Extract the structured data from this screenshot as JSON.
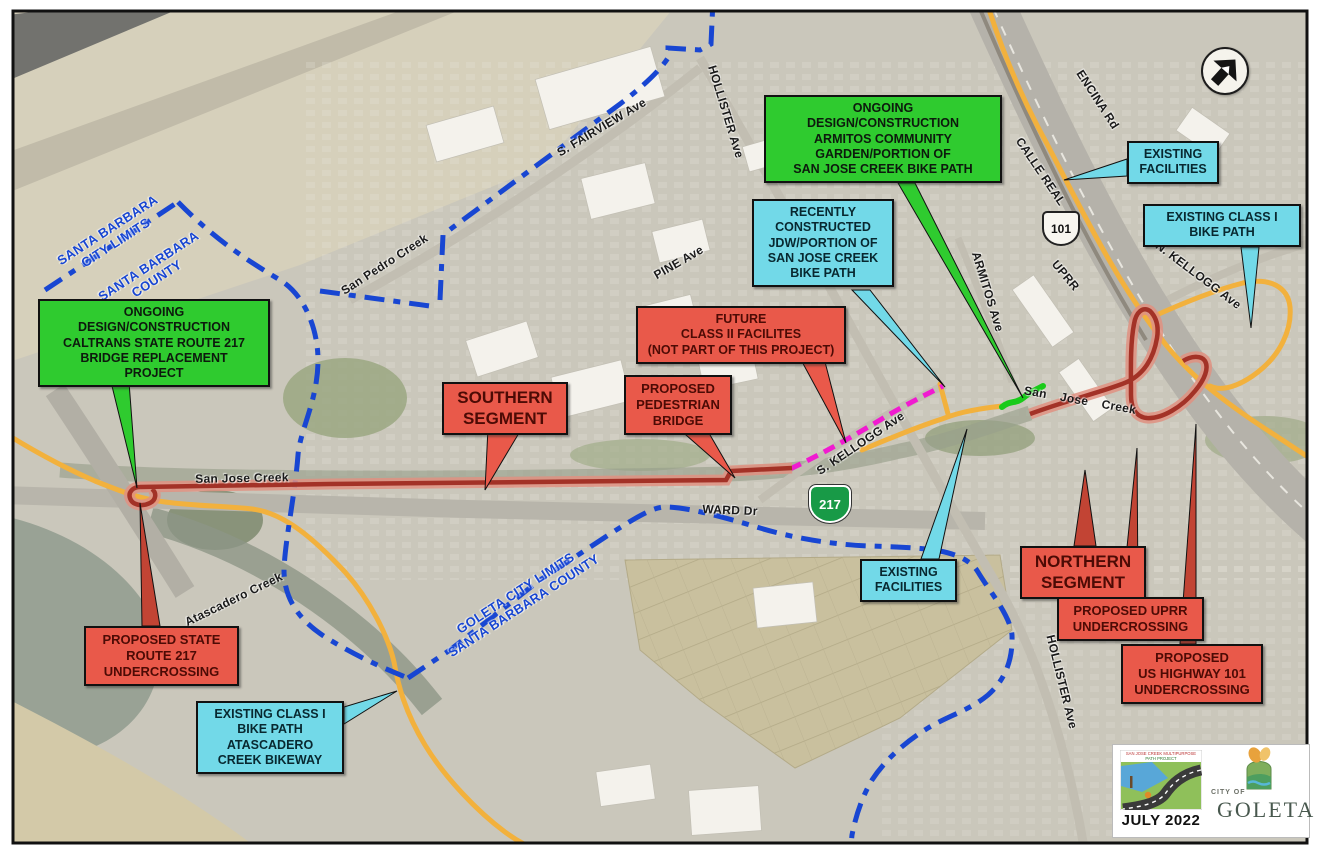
{
  "callouts": {
    "caltrans": "ONGOING\nDESIGN/CONSTRUCTION\nCALTRANS STATE ROUTE 217\nBRIDGE REPLACEMENT\nPROJECT",
    "garden": "ONGOING\nDESIGN/CONSTRUCTION\nARMITOS COMMUNITY\nGARDEN/PORTION OF\nSAN JOSE CREEK BIKE PATH",
    "recently": "RECENTLY\nCONSTRUCTED\nJDW/PORTION OF\nSAN JOSE CREEK\nBIKE PATH",
    "existing_facilities_ne": "EXISTING\nFACILITIES",
    "existing_class1_ne": "EXISTING CLASS I\nBIKE PATH",
    "future": "FUTURE\nCLASS II FACILITES\n(NOT PART OF THIS PROJECT)",
    "southern": "SOUTHERN\nSEGMENT",
    "pedestrian": "PROPOSED\nPEDESTRIAN\nBRIDGE",
    "r217": "PROPOSED STATE\nROUTE 217\nUNDERCROSSING",
    "atascadero": "EXISTING CLASS I\nBIKE PATH\nATASCADERO\nCREEK BIKEWAY",
    "existing_facilities_s": "EXISTING\nFACILITIES",
    "northern": "NORTHERN\nSEGMENT",
    "uprr": "PROPOSED UPRR\nUNDERCROSSING",
    "us101": "PROPOSED\nUS HIGHWAY 101\nUNDERCROSSING"
  },
  "labels": {
    "sb_city_limits": "SANTA BARBARA\nCITY LIMITS",
    "sb_county": "SANTA BARBARA\nCOUNTY",
    "san_pedro_creek": "San Pedro Creek",
    "s_fairview": "S. FAIRVIEW Ave",
    "hollister_n": "HOLLISTER Ave",
    "pine": "PINE Ave",
    "armitos": "ARMITOS Ave",
    "calle_real": "CALLE REAL",
    "encina": "ENCINA Rd",
    "uprr": "UPRR",
    "n_kellogg": "N. KELLOGG Ave",
    "san_jose_creek_w": "San Jose Creek",
    "san_jose_creek_e": "San Jose Creek",
    "s_kellogg": "S. KELLOGG Ave",
    "ward": "WARD Dr",
    "atascadero_creek": "Atascadero Creek",
    "goleta_limits": "GOLETA CITY LIMITS\nSANTA BARBARA COUNTY",
    "hollister_s": "HOLLISTER Ave"
  },
  "shields": {
    "us101": "101",
    "ca217": "217"
  },
  "footer": {
    "date": "JULY 2022",
    "city_of": "CITY OF",
    "city_name": "GOLETA",
    "project_line1": "SAN JOSE CREEK MULTIPURPOSE",
    "project_line2": "PATH PROJECT"
  },
  "colors": {
    "callout_green": "#2fcb2f",
    "callout_cyan": "#72d9e8",
    "callout_red": "#e9594a",
    "proposed_route_red": "#a33227",
    "existing_path_orange": "#f2b13d",
    "future_magenta": "#f01ad0",
    "city_limits_blue": "#1846d2",
    "built_segment_green": "#19cb19"
  }
}
